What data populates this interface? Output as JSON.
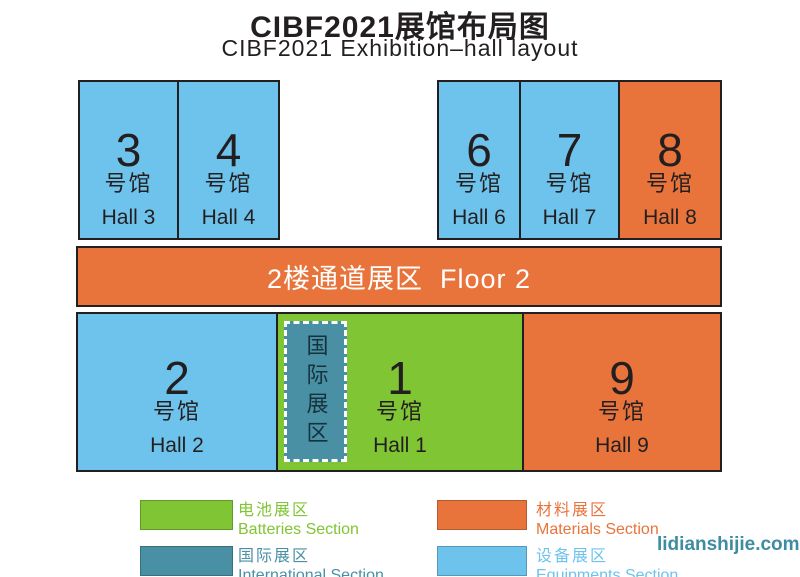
{
  "header": {
    "title": "CIBF2021展馆布局图",
    "subtitle": "CIBF2021 Exhibition–hall layout"
  },
  "colors": {
    "blue": "#6EC3EC",
    "orange": "#E8743C",
    "green": "#80C533",
    "teal": "#4A90A5",
    "border": "#231F20"
  },
  "halls": [
    {
      "number": "3",
      "unit": "号馆",
      "label": "Hall 3"
    },
    {
      "number": "4",
      "unit": "号馆",
      "label": "Hall 4"
    },
    {
      "number": "6",
      "unit": "号馆",
      "label": "Hall 6"
    },
    {
      "number": "7",
      "unit": "号馆",
      "label": "Hall 7"
    },
    {
      "number": "8",
      "unit": "号馆",
      "label": "Hall 8"
    },
    {
      "number": "2",
      "unit": "号馆",
      "label": "Hall 2"
    },
    {
      "number": "1",
      "unit": "号馆",
      "label": "Hall 1"
    },
    {
      "number": "9",
      "unit": "号馆",
      "label": "Hall 9"
    }
  ],
  "floor2": {
    "label": "2楼通道展区  Floor 2"
  },
  "international_area": {
    "label": "国际展区"
  },
  "legend": {
    "items": [
      {
        "cn": "电池展区",
        "en": "Batteries Section",
        "color": "#80C533"
      },
      {
        "cn": "国际展区",
        "en": "International Section",
        "color": "#4A90A5"
      },
      {
        "cn": "材料展区",
        "en": "Materials Section",
        "color": "#E8743C"
      },
      {
        "cn": "设备展区",
        "en": "Equipments Section",
        "color": "#6EC3EC"
      }
    ]
  },
  "watermark": {
    "text": "lidianshijie.com",
    "color": "#3E8CA2"
  }
}
